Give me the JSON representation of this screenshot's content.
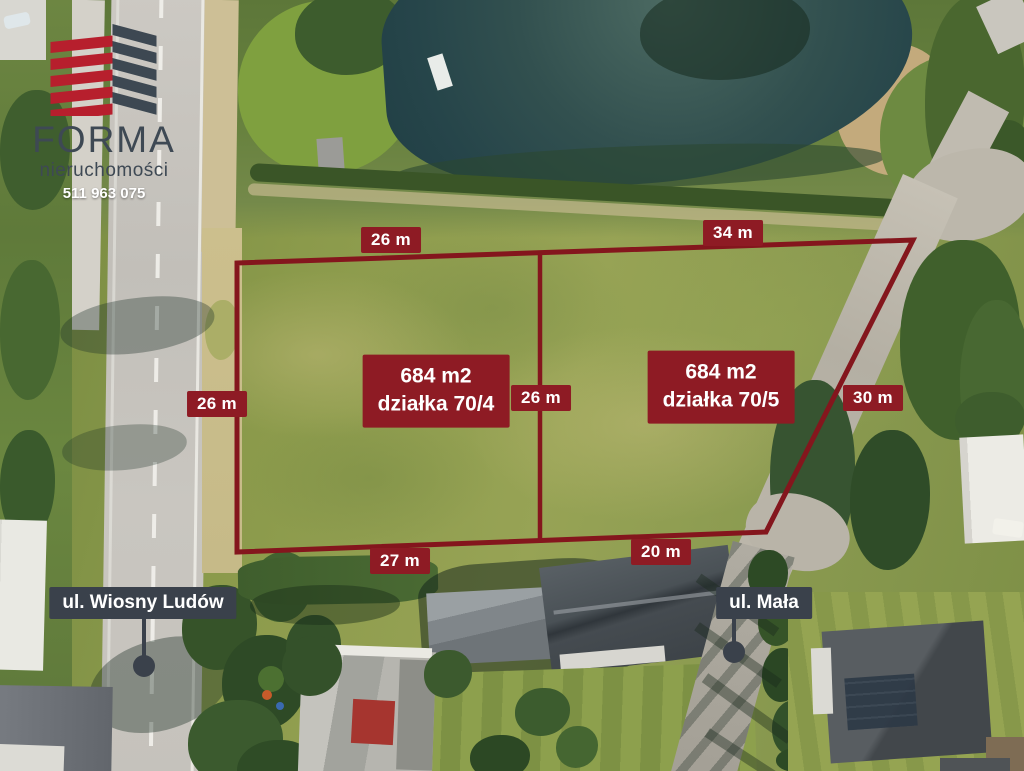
{
  "branding": {
    "name": "FORMA",
    "subtitle": "nieruchomości",
    "phone": "511 963 075"
  },
  "icons": {
    "logo": "building-logo-icon",
    "street_marker": "map-pin-dot-icon"
  },
  "plots": [
    {
      "area": "684 m2",
      "label": "działka 70/4"
    },
    {
      "area": "684 m2",
      "label": "działka 70/5"
    }
  ],
  "dimensions": [
    {
      "position": "top-left",
      "text": "26 m"
    },
    {
      "position": "top-right",
      "text": "34 m"
    },
    {
      "position": "left",
      "text": "26 m"
    },
    {
      "position": "center",
      "text": "26 m"
    },
    {
      "position": "right",
      "text": "30 m"
    },
    {
      "position": "bottom-left",
      "text": "27 m"
    },
    {
      "position": "bottom-right",
      "text": "20 m"
    }
  ],
  "streets": [
    {
      "name": "ul. Wiosny Ludów"
    },
    {
      "name": "ul. Mała"
    }
  ],
  "colors": {
    "boundary": "#84161d",
    "dimension_box": "#8e1b24",
    "street_box": "#3a414b",
    "logo_red": "#b71f2d",
    "logo_slate": "#3d4852"
  }
}
